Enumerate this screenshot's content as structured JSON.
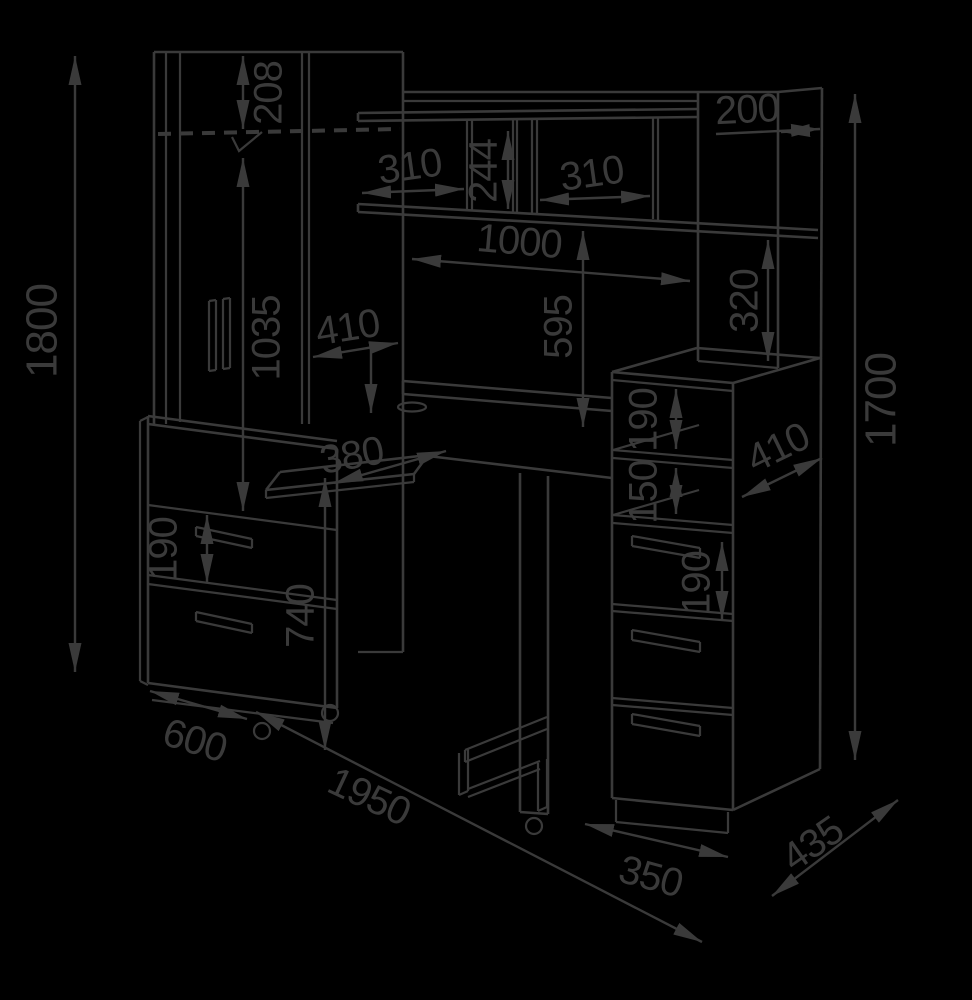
{
  "meta": {
    "type": "furniture-dimension-drawing",
    "background": "#000000",
    "ink": "#3a3a3a",
    "units": "mm"
  },
  "dimensions": {
    "wardrobe_height": "1800",
    "rail_offset_top": "208",
    "hanging_height": "1035",
    "hutch_left_shelf_width": "310",
    "hutch_mid_height": "244",
    "hutch_right_shelf_width": "310",
    "hutch_span": "1000",
    "top_cabinet_depth": "200",
    "cabinet_niche_height": "320",
    "hutch_above_desk": "595",
    "desk_side_depth": "410",
    "tray_depth": "380",
    "desk_height": "740",
    "mobile_drawer_height": "190",
    "shelf_niche_a": "190",
    "shelf_niche_b": "150",
    "pedestal_depth": "410",
    "pedestal_drawer_height": "190",
    "right_height": "1700",
    "wardrobe_depth": "600",
    "total_width": "1950",
    "pedestal_width": "350",
    "pedestal_diagonal_depth": "435"
  }
}
